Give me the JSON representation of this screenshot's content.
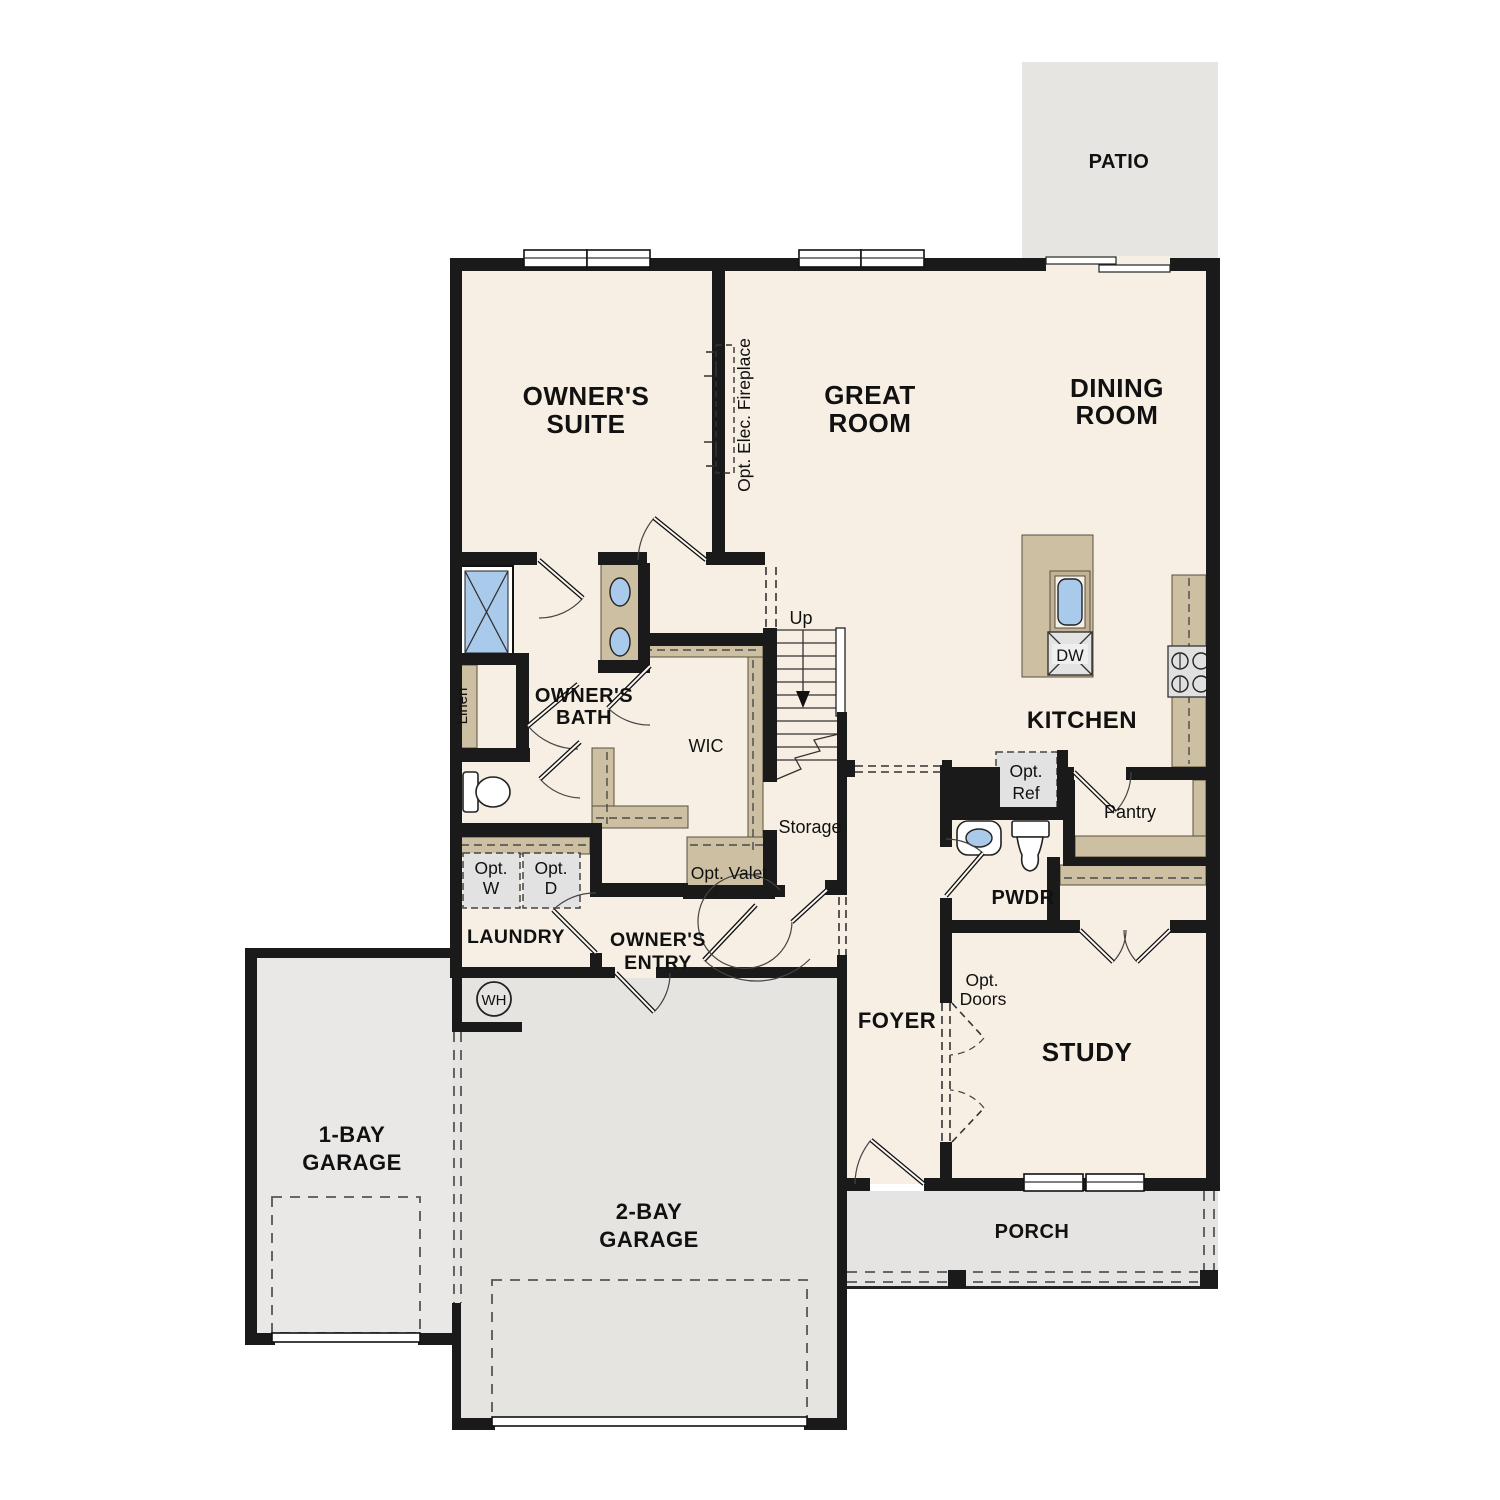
{
  "plan": {
    "type": "single-family-home-first-floor-plan",
    "rooms": {
      "patio": {
        "label": "PATIO"
      },
      "owners_suite": {
        "line1": "OWNER'S",
        "line2": "SUITE"
      },
      "great_room": {
        "line1": "GREAT",
        "line2": "ROOM"
      },
      "dining_room": {
        "line1": "DINING",
        "line2": "ROOM"
      },
      "owners_bath": {
        "line1": "OWNER'S",
        "line2": "BATH"
      },
      "wic": {
        "label": "WIC"
      },
      "linen": {
        "label": "Linen"
      },
      "kitchen": {
        "label": "KITCHEN"
      },
      "pantry": {
        "label": "Pantry"
      },
      "storage": {
        "label": "Storage"
      },
      "laundry": {
        "label": "LAUNDRY"
      },
      "owners_entry": {
        "line1": "OWNER'S",
        "line2": "ENTRY"
      },
      "pwdr": {
        "label": "PWDR"
      },
      "foyer": {
        "label": "FOYER"
      },
      "study": {
        "label": "STUDY"
      },
      "garage_1bay": {
        "line1": "1-BAY",
        "line2": "GARAGE"
      },
      "garage_2bay": {
        "line1": "2-BAY",
        "line2": "GARAGE"
      },
      "porch": {
        "label": "PORCH"
      }
    },
    "features": {
      "stairs_up": "Up",
      "fireplace": "Opt. Elec. Fireplace",
      "opt_valet": "Opt. Valet",
      "opt_washer": {
        "line1": "Opt.",
        "line2": "W"
      },
      "opt_dryer": {
        "line1": "Opt.",
        "line2": "D"
      },
      "opt_ref": {
        "line1": "Opt.",
        "line2": "Ref"
      },
      "opt_doors": {
        "line1": "Opt.",
        "line2": "Doors"
      },
      "dishwasher": "DW",
      "water_heater": "WH"
    },
    "colors": {
      "wall": "#1a1a1a",
      "floor_interior": "#f7efe4",
      "floor_patio": "#e6e5e2",
      "floor_garage_1bay": "#e9e8e6",
      "floor_garage_2bay": "#e5e4e1",
      "floor_porch": "#e5e4e2",
      "cabinetry": "#cdbfa2",
      "fixture_blue": "#aacaeb",
      "appliance_gray": "#e2e2e2"
    }
  }
}
